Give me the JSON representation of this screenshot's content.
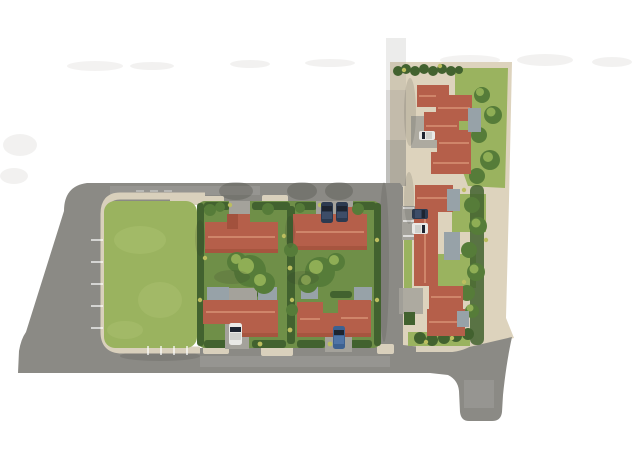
{
  "app": {
    "title": "Residential development site plan — aerial 3D render",
    "type": "architectural-masterplan-image"
  },
  "scene": {
    "background": "#ffffff",
    "palette": {
      "road": "#8b8a85",
      "road_faint": "#c7c6c2",
      "sidewalk": "#d9d0bc",
      "sand": "#ddd3bd",
      "lawn": "#9ab35f",
      "lawn_light": "#aabf6e",
      "garden": "#6f8f48",
      "hedge": "#42622f",
      "hedge_light": "#7ba04a",
      "hedge_accent": "#bcbe5f",
      "tree": "#567c39",
      "tree_light": "#8fae55",
      "roof": "#b55f4a",
      "roof_light": "#d18a6e",
      "roof_dark": "#8f4430",
      "carport": "#97a2a8",
      "driveway": "#a4a29b",
      "car_navy": "#2c3a50",
      "car_navy_roof": "#3d4d68",
      "car_white": "#e9e9e6",
      "car_white_roof": "#cfd0cc",
      "car_blue": "#3d6191",
      "car_blue_roof": "#507506",
      "car_glass": "#1d2430",
      "marking": "#ffffff"
    },
    "inventory": {
      "description": "Aerial plan of a housing estate: looped access road around a central lawn, four red-tile-roof houses in a hedged central block, a terraced strip of red-roof buildings on sand to the north-east, carports, trees, hedges and seven parked cars; road exits at bottom right.",
      "central_houses": 4,
      "northeast_buildings": 9,
      "carports": 8,
      "large_trees": 8,
      "parked_cars": [
        {
          "color": "navy",
          "location": "north driveway of central block"
        },
        {
          "color": "navy",
          "location": "north driveway of central block"
        },
        {
          "color": "white",
          "location": "south driveway of central block"
        },
        {
          "color": "blue",
          "location": "south driveway of central block"
        },
        {
          "color": "white",
          "location": "north-east cluster driveway"
        },
        {
          "color": "navy",
          "location": "east strip parking bay"
        },
        {
          "color": "white",
          "location": "east strip parking bay"
        }
      ]
    }
  }
}
